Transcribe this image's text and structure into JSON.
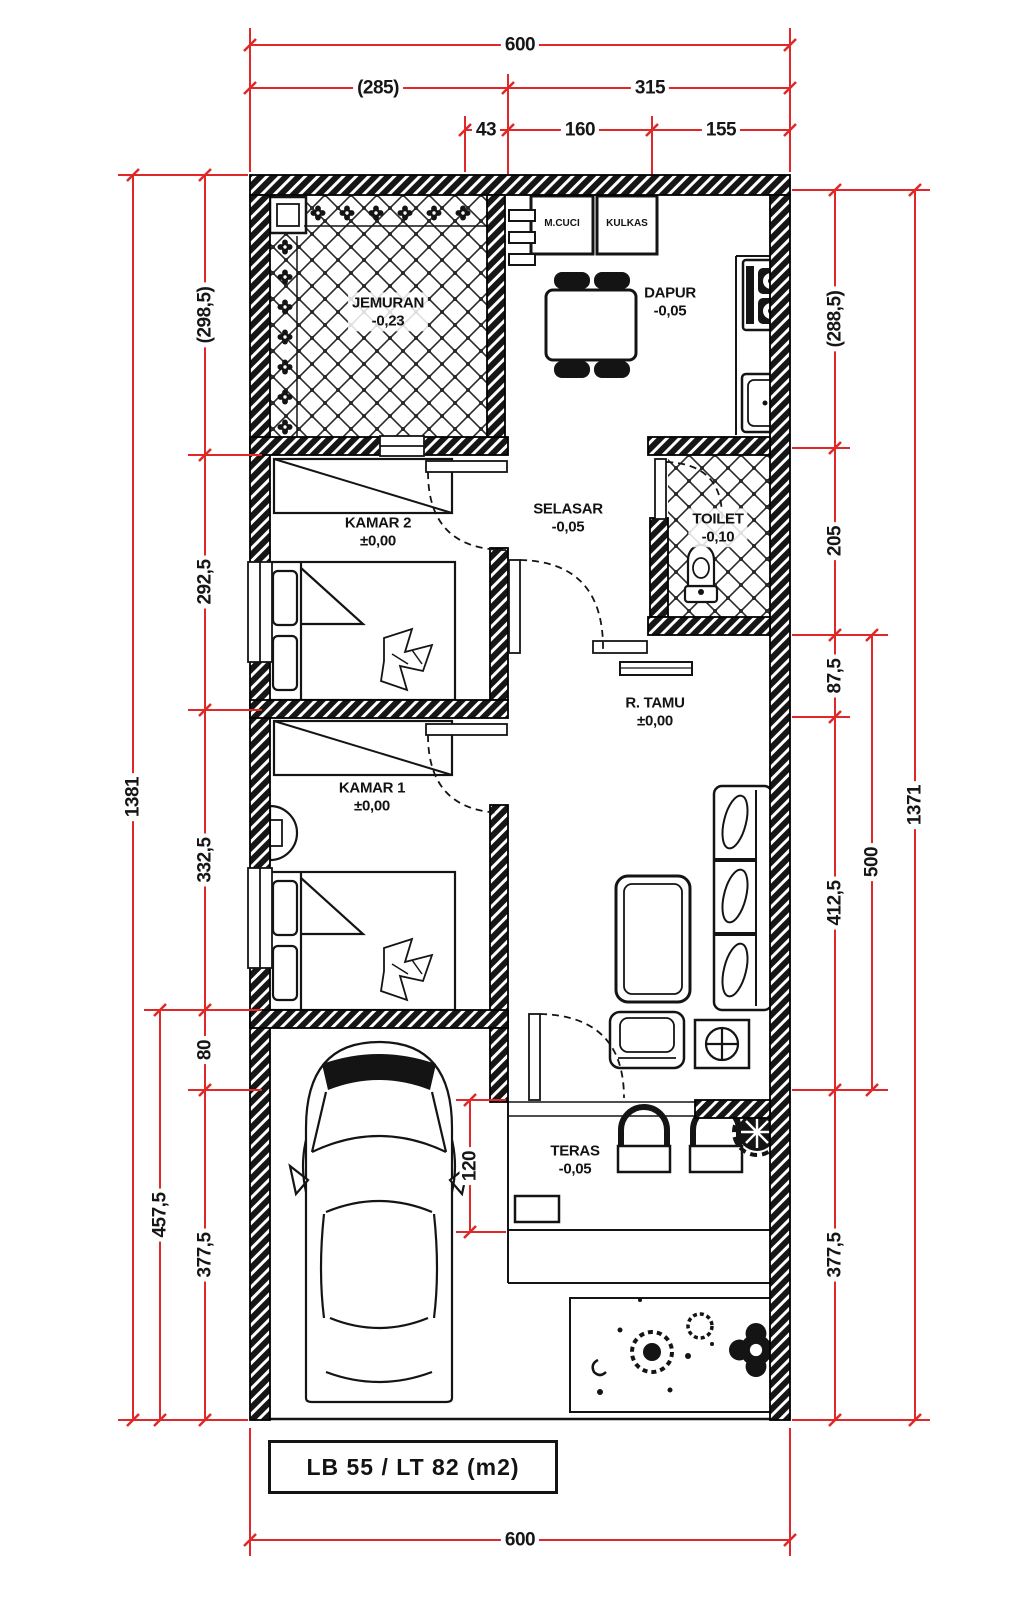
{
  "meta": {
    "drawing_type": "house floor plan"
  },
  "colors": {
    "dim_red": "#e02828",
    "ink": "#141414",
    "paper": "#ffffff"
  },
  "dims": {
    "top": {
      "total": "600",
      "row2": [
        "(285)",
        "315"
      ],
      "row3": [
        "43",
        "160",
        "155"
      ]
    },
    "left": {
      "total": "1381",
      "chain": [
        "(298,5)",
        "292,5",
        "332,5",
        "80",
        "377,5"
      ],
      "mid": "457,5"
    },
    "right": {
      "total": "1371",
      "chain": [
        "(288,5)",
        "205",
        "87,5",
        "412,5",
        "377,5"
      ],
      "mid": "500"
    },
    "bottom": {
      "total": "600"
    },
    "teras_depth": "120"
  },
  "rooms": {
    "jemuran": {
      "name": "JEMURAN",
      "level": "-0,23"
    },
    "dapur": {
      "name": "DAPUR",
      "level": "-0,05"
    },
    "kamar2": {
      "name": "KAMAR 2",
      "level": "±0,00"
    },
    "selasar": {
      "name": "SELASAR",
      "level": "-0,05"
    },
    "toilet": {
      "name": "TOILET",
      "level": "-0,10"
    },
    "kamar1": {
      "name": "KAMAR 1",
      "level": "±0,00"
    },
    "r_tamu": {
      "name": "R. TAMU",
      "level": "±0,00"
    },
    "teras": {
      "name": "TERAS",
      "level": "-0,05"
    }
  },
  "appliances": {
    "washer": "M.CUCI",
    "fridge": "KULKAS"
  },
  "footer": {
    "area_label": "LB 55 / LT 82 (m2)"
  }
}
